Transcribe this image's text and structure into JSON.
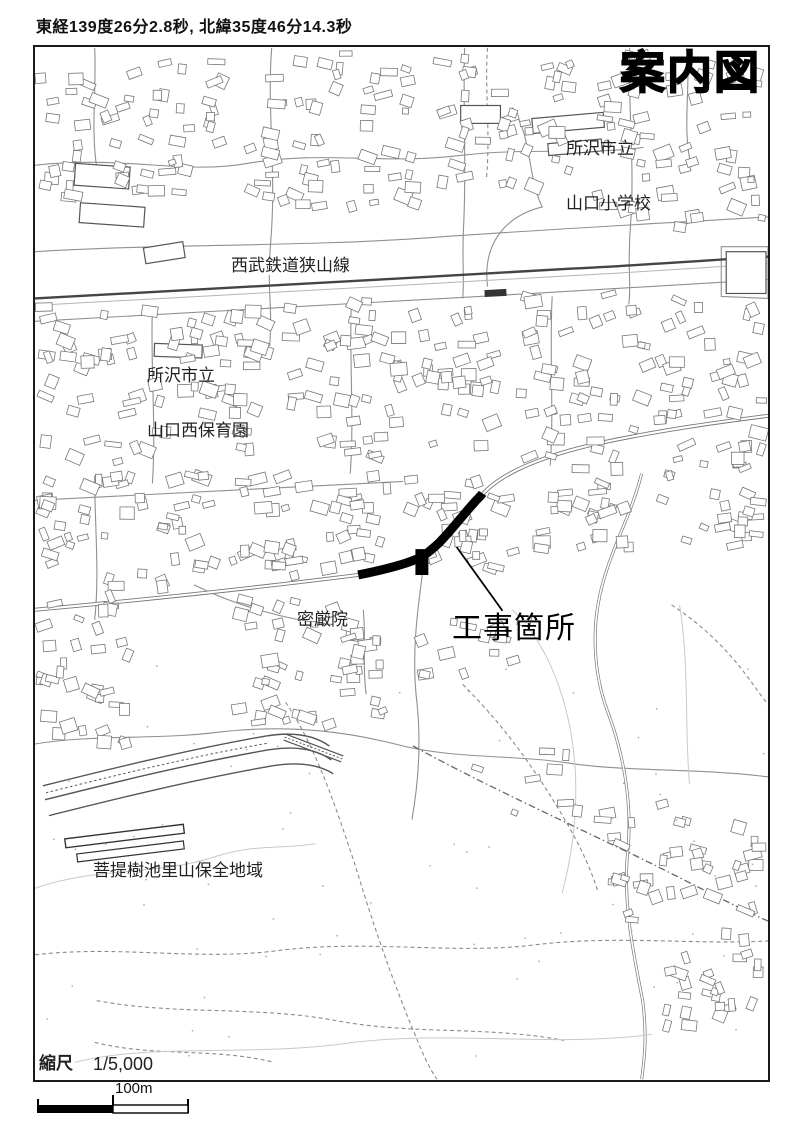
{
  "header": {
    "coordinates": "東経139度26分2.8秒, 北緯35度46分14.3秒"
  },
  "map": {
    "title": "案内図",
    "labels": {
      "school_line1": "所沢市立",
      "school_line2": "山口小学校",
      "railway": "西武鉄道狭山線",
      "nursery_line1": "所沢市立",
      "nursery_line2": "山口西保育園",
      "temple": "密厳院",
      "construction": "工事箇所",
      "conservation": "菩提樹池里山保全地域"
    },
    "colors": {
      "highlight": "#000000",
      "frame": "#1a1a1a",
      "line": "#8f8f8f"
    }
  },
  "footer": {
    "scale_label": "縮尺",
    "scale_value": "1/5,000",
    "bar_label": "100m"
  }
}
